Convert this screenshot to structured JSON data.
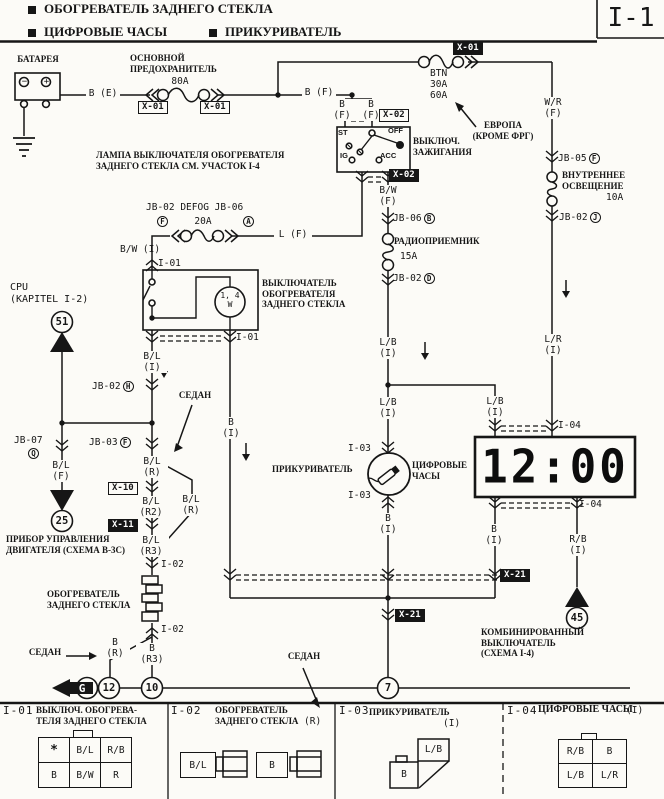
{
  "colors": {
    "paper": "#fcfbf7",
    "ink": "#161616"
  },
  "header": {
    "item1": "ОБОГРЕВАТЕЛЬ ЗАДНЕГО СТЕКЛА",
    "item2": "ЦИФРОВЫЕ ЧАСЫ",
    "item3": "ПРИКУРИВАТЕЛЬ",
    "page_code": "I-1"
  },
  "labels": {
    "battery": "БАТАРЕЯ",
    "main_fuse": "ОСНОВНОЙ\nПРЕДОХРАНИТЕЛЬ",
    "main_fuse_a": "80A",
    "b_e": "B (E)",
    "x01": "X-01",
    "b_f": "B (F)",
    "btn": "BTN\n30A\n60A",
    "w_r": "W/R\n(F)",
    "europe": "ЕВРОПА\n(КРОМЕ ФРГ)",
    "x02": "X-02",
    "ign": "ВЫКЛЮЧ.\nЗАЖИГАНИЯ",
    "st": "ST",
    "ig": "IG",
    "acc": "ACC",
    "off": "OFF",
    "b_w_f": "B/W\n(F)",
    "lamp_note": "ЛАМПА ВЫКЛЮЧАТЕЛЯ ОБОГРЕВАТЕЛЯ\nЗАДНЕГО СТЕКЛА СМ. УЧАСТОК I-4",
    "defog": "JB-02 DEFOG JB-06",
    "a20": "20A",
    "l_f": "L (F)",
    "b_w_i": "B/W (I)",
    "i01": "I-01",
    "rear_sw": "ВЫКЛЮЧАТЕЛЬ\nОБОГРЕВАТЕЛЯ\nЗАДНЕГО СТЕКЛА",
    "lamp_w": "1, 4\nW",
    "cpu": "CPU\n(KAPITEL I-2)",
    "b_l_i": "B/L\n(I)",
    "jb02": "JB-02",
    "jb03": "JB-03",
    "jb05": "JB-05",
    "jb06": "JB-06",
    "jb07": "JB-07",
    "sedan": "СЕДАН",
    "b_i": "B\n(I)",
    "b_l_f": "B/L\n(F)",
    "ecu": "ПРИБОР УПРАВЛЕНИЯ\nДВИГАТЕЛЯ (СХЕМА B-3C)",
    "b_l_r": "B/L\n(R)",
    "b_l_r2": "B/L\n(R2)",
    "b_l_r3": "B/L\n(R3)",
    "x10": "X-10",
    "x11": "X-11",
    "x21": "X-21",
    "i02": "I-02",
    "heater": "ОБОГРЕВАТЕЛЬ\nЗАДНЕГО СТЕКЛА",
    "b_r": "B\n(R)",
    "b_r3": "B\n(R3)",
    "g": "G",
    "radio": "РАДИОПРИЕМНИК",
    "a15": "15A",
    "l_b_i": "L/B\n(I)",
    "lighter": "ПРИКУРИВАТЕЛЬ",
    "i03": "I-03",
    "clock2": "ЦИФРОВЫЕ\nЧАСЫ",
    "interior": "ВНУТРЕННЕЕ\nОСВЕЩЕНИЕ",
    "a10": "10A",
    "l_r_i": "L/R\n(I)",
    "i04": "I-04",
    "r_b_i": "R/B\n(I)",
    "combo": "КОМБИНИРОВАННЫЙ\nВЫКЛЮЧАТЕЛЬ\n(СХЕМА I-4)"
  },
  "circled": {
    "a": "A",
    "b": "B",
    "d": "D",
    "f": "F",
    "h": "H",
    "j": "J",
    "q": "Q"
  },
  "terminals": {
    "t51": "51",
    "t25": "25",
    "t45": "45",
    "t11": "11",
    "t12": "12",
    "t10": "10",
    "t7": "7",
    "minus": "−",
    "plus": "+"
  },
  "clock": {
    "time": "12:00"
  },
  "panel": {
    "i01": {
      "code": "I-01",
      "title": "ВЫКЛЮЧ. ОБОГРЕВА-\nТЕЛЯ ЗАДНЕГО СТЕКЛА",
      "pins": [
        "*",
        "B/L",
        "R/B",
        "B",
        "B/W",
        "R"
      ]
    },
    "i02": {
      "code": "I-02",
      "title": "ОБОГРЕВАТЕЛЬ\nЗАДНЕГО СТЕКЛА",
      "tag": "(R)",
      "pins": [
        "B/L",
        "B"
      ]
    },
    "i03": {
      "code": "I-03",
      "title": "ПРИКУРИВАТЕЛЬ",
      "tag": "(I)",
      "pins": [
        "L/B",
        "B"
      ]
    },
    "i04": {
      "code": "I-04",
      "title": "ЦИФРОВЫЕ ЧАСЫ",
      "tag": "(I)",
      "pins": [
        "R/B",
        "B",
        "L/B",
        "L/R"
      ]
    }
  }
}
